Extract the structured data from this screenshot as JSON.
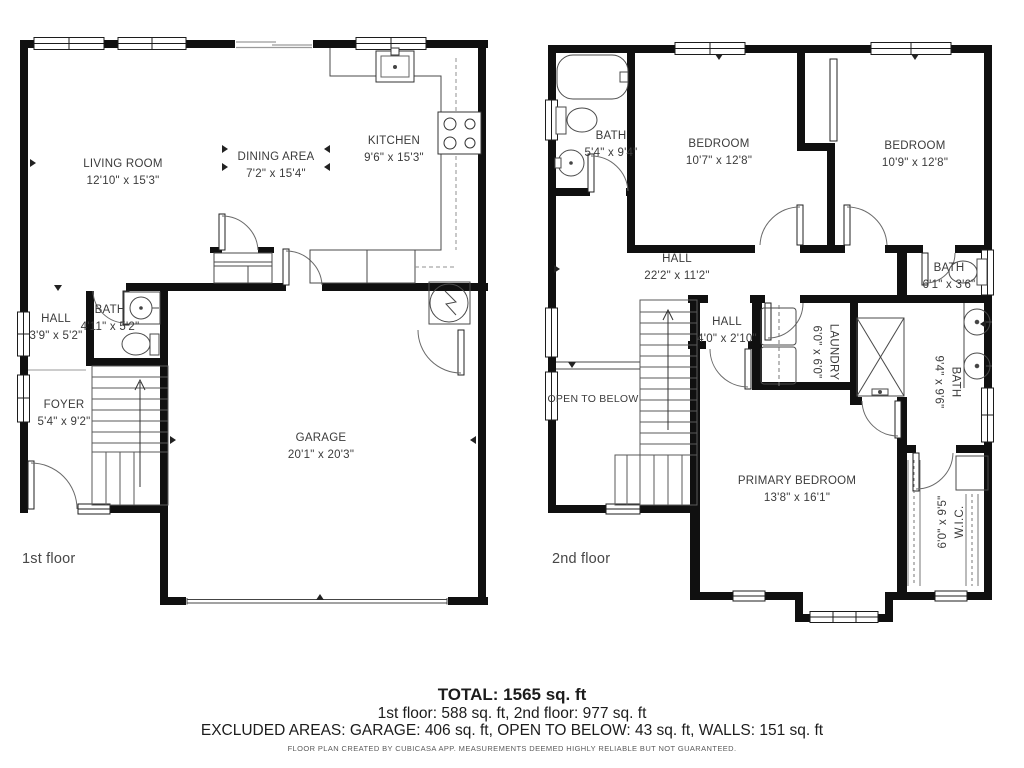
{
  "floor1": {
    "label": "1st floor",
    "rooms": {
      "living": {
        "name": "LIVING ROOM",
        "dims": "12'10\" x 15'3\""
      },
      "dining": {
        "name": "DINING AREA",
        "dims": "7'2\" x 15'4\""
      },
      "kitchen": {
        "name": "KITCHEN",
        "dims": "9'6\" x 15'3\""
      },
      "bath": {
        "name": "BATH",
        "dims": "4'11\" x 5'2\""
      },
      "hall": {
        "name": "HALL",
        "dims": "3'9\" x 5'2\""
      },
      "foyer": {
        "name": "FOYER",
        "dims": "5'4\" x 9'2\""
      },
      "garage": {
        "name": "GARAGE",
        "dims": "20'1\" x 20'3\""
      }
    }
  },
  "floor2": {
    "label": "2nd floor",
    "rooms": {
      "bath": {
        "name": "BATH",
        "dims": "5'4\" x 9'4\""
      },
      "bedroom1": {
        "name": "BEDROOM",
        "dims": "10'7\" x 12'8\""
      },
      "bedroom2": {
        "name": "BEDROOM",
        "dims": "10'9\" x 12'8\""
      },
      "hall": {
        "name": "HALL",
        "dims": "22'2\" x 11'2\""
      },
      "bath2": {
        "name": "BATH",
        "dims": "6'1\" x 3'6\""
      },
      "hall2": {
        "name": "HALL",
        "dims": "4'0\" x 2'10\""
      },
      "laundry": {
        "name": "LAUNDRY",
        "dims": "6'0\" x 6'0\""
      },
      "open": {
        "name": "OPEN TO BELOW"
      },
      "bath3": {
        "name": "BATH",
        "dims": "9'4\" x 9'6\""
      },
      "primary": {
        "name": "PRIMARY BEDROOM",
        "dims": "13'8\" x 16'1\""
      },
      "wic": {
        "name": "W.I.C.",
        "dims": "6'0\" x 9'5\""
      }
    }
  },
  "summary": {
    "total": "TOTAL: 1565 sq. ft",
    "floors": "1st floor: 588 sq. ft, 2nd floor: 977 sq. ft",
    "excluded": "EXCLUDED AREAS: GARAGE: 406 sq. ft, OPEN TO BELOW: 43 sq. ft, WALLS: 151 sq. ft",
    "disclaimer": "FLOOR PLAN CREATED BY CUBICASA APP. MEASUREMENTS DEEMED HIGHLY RELIABLE BUT NOT GUARANTEED."
  }
}
